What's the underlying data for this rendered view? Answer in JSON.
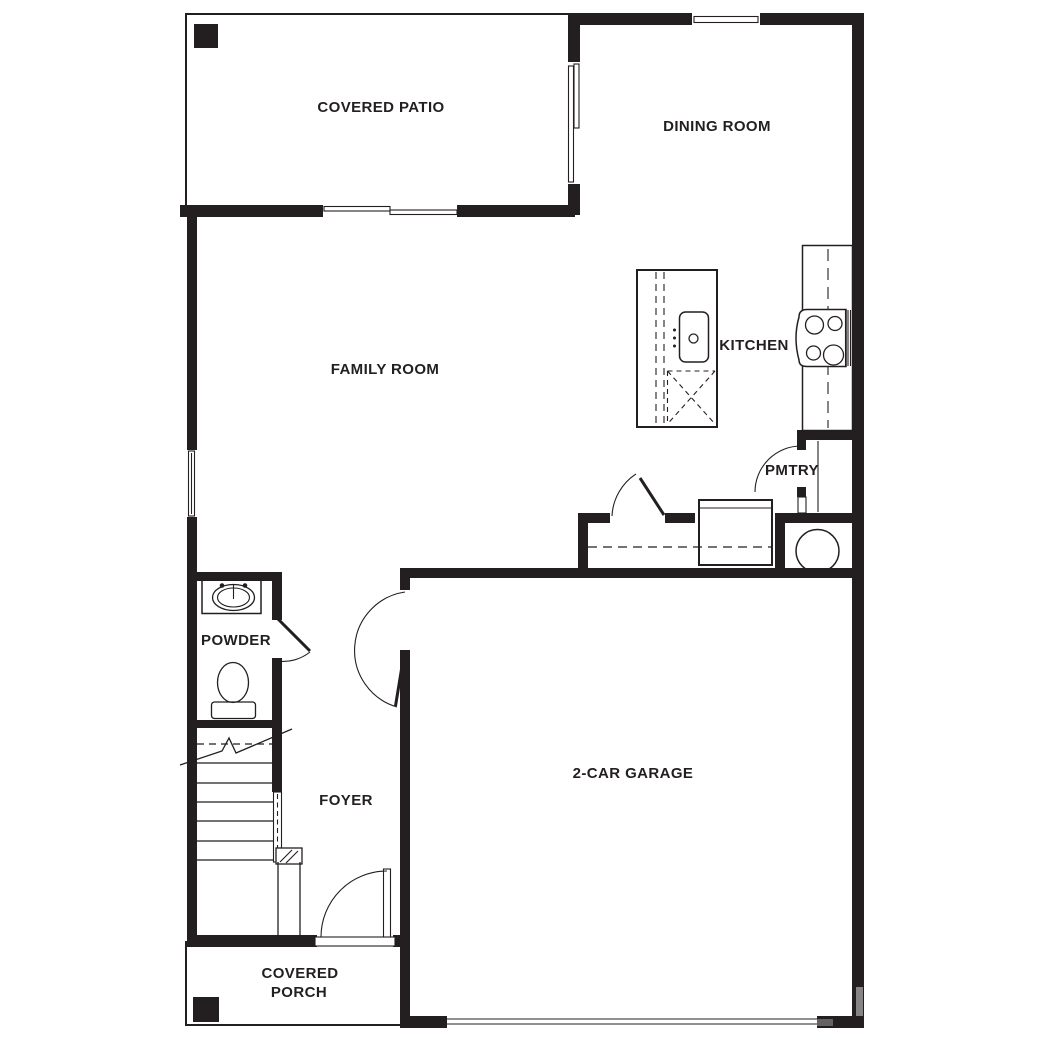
{
  "document": {
    "type": "floor-plan",
    "floor": "first-floor"
  },
  "colors": {
    "wall": "#231f20",
    "paper": "#ffffff"
  },
  "labels": {
    "covered_patio": "COVERED PATIO",
    "dining_room": "DINING ROOM",
    "family_room": "FAMILY ROOM",
    "kitchen": "KITCHEN",
    "pantry": "PMTRY",
    "powder_room": "POWDER",
    "foyer": "FOYER",
    "garage": "2-CAR GARAGE",
    "covered_porch_line1": "COVERED",
    "covered_porch_line2": "PORCH"
  },
  "fixtures": [
    "kitchen-island",
    "island-sink",
    "dishwasher-box",
    "range-cooktop",
    "kitchen-counter",
    "pantry-shelf",
    "pantry-door",
    "coat-closet",
    "closet-rod",
    "closet-door",
    "laundry-appliance",
    "water-heater",
    "stairs-up",
    "stair-rail",
    "newel-post",
    "powder-vanity",
    "powder-sink",
    "toilet",
    "powder-door",
    "front-door",
    "garage-entry-door",
    "garage-door",
    "patio-sliding-door",
    "patio-side-sliding-door",
    "dining-window",
    "family-room-window",
    "patio-post",
    "porch-post"
  ]
}
